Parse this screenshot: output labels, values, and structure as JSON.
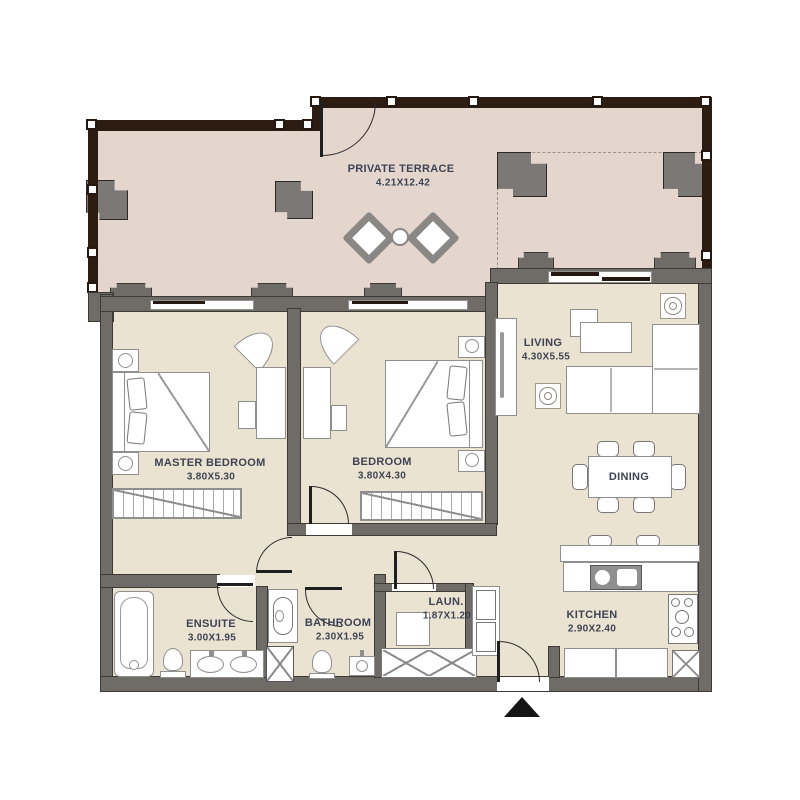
{
  "plan": {
    "colors": {
      "wall": "#6f6b67",
      "band": "#2d1c12",
      "terrace": "#e4d6cd",
      "floor": "#ebe3d1",
      "ink": "#3d4354"
    },
    "rooms": [
      {
        "id": "private-terrace",
        "name": "PRIVATE TERRACE",
        "dims": "4.21X12.42"
      },
      {
        "id": "master-bedroom",
        "name": "MASTER BEDROOM",
        "dims": "3.80X5.30"
      },
      {
        "id": "bedroom",
        "name": "BEDROOM",
        "dims": "3.80X4.30"
      },
      {
        "id": "living",
        "name": "LIVING",
        "dims": "4.30X5.55"
      },
      {
        "id": "dining",
        "name": "DINING",
        "dims": ""
      },
      {
        "id": "ensuite",
        "name": "ENSUITE",
        "dims": "3.00X1.95"
      },
      {
        "id": "bathroom",
        "name": "BATHROOM",
        "dims": "2.30X1.95"
      },
      {
        "id": "laundry",
        "name": "LAUN.",
        "dims": "1.87X1.20"
      },
      {
        "id": "kitchen",
        "name": "KITCHEN",
        "dims": "2.90X2.40"
      }
    ]
  }
}
